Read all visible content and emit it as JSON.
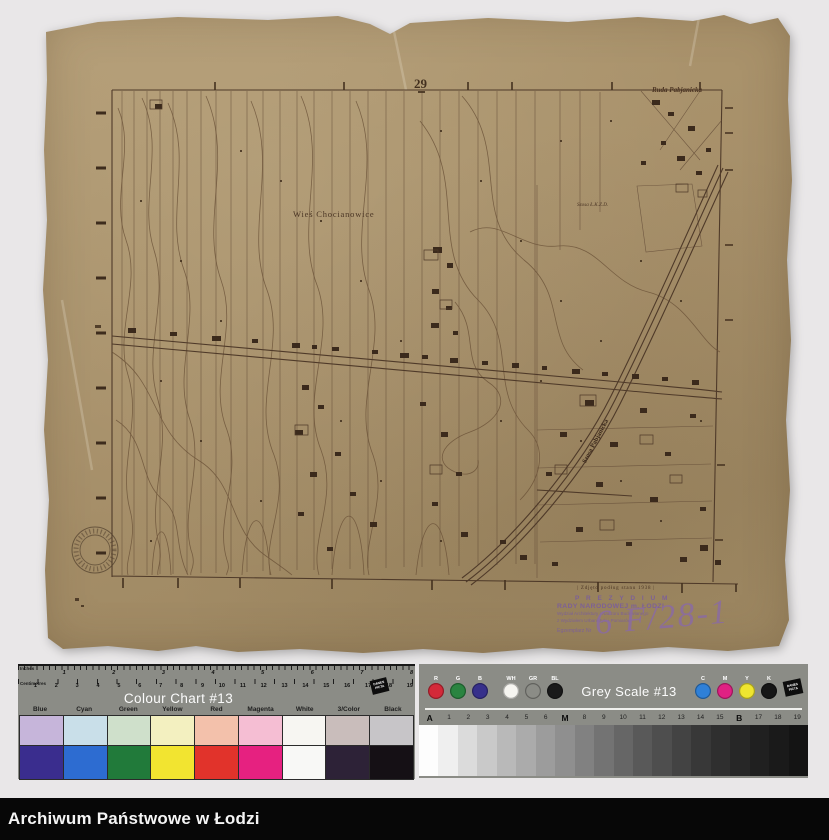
{
  "palette": {
    "background": "#e9e7e8",
    "paper": "#a8916b",
    "map_ink": "#4f3a29",
    "stamp_purple": "#7c5f99",
    "chart_grey": "#8b8c86",
    "footer_black": "#070707"
  },
  "map": {
    "sheet_number": "29",
    "corner_label": "Ruda Pabjanicka",
    "village_label": "Wieś Chocianowice",
    "road_label_small": "Szosa Ł.K.Z.D.",
    "road_label_diagonal": "Szosa Pabjanicka",
    "survey_note": "| Zdjęto podług stanu 1938 |",
    "stamp": {
      "line1": "P R E Z Y D I U M",
      "line2": "RADY NARODOWEJ m. ŁODZI",
      "line3": "Wydział Architektury i Nadzoru Budowlanego",
      "line4": "z Wydziałem Urbanistyki i Pomiarów",
      "line5": "Egzemplarz Nr",
      "handwritten": "6 F/28-1"
    }
  },
  "colour_chart": {
    "title": "Colour Chart #13",
    "ruler_top_label": "Inches",
    "ruler_bottom_label": "Centimetres",
    "logo_text": "DANES PICTA",
    "inch_numbers": [
      "1",
      "2",
      "3",
      "4",
      "5",
      "6",
      "7",
      "8"
    ],
    "cm_numbers": [
      "1",
      "2",
      "3",
      "4",
      "5",
      "6",
      "7",
      "8",
      "9",
      "10",
      "11",
      "12",
      "13",
      "14",
      "15",
      "16",
      "17",
      "18",
      "19"
    ],
    "columns": [
      {
        "label": "Blue",
        "light": "#c6b5da",
        "dark": "#3a2d8e"
      },
      {
        "label": "Cyan",
        "light": "#c9dfe9",
        "dark": "#2d6cd1"
      },
      {
        "label": "Green",
        "light": "#cfe0cb",
        "dark": "#217a3a"
      },
      {
        "label": "Yellow",
        "light": "#f3f0c0",
        "dark": "#f2e430"
      },
      {
        "label": "Red",
        "light": "#f3c1ab",
        "dark": "#e1332b"
      },
      {
        "label": "Magenta",
        "light": "#f5bed3",
        "dark": "#e62180"
      },
      {
        "label": "White",
        "light": "#f7f6f2",
        "dark": "#f8f8f6"
      },
      {
        "label": "3/Color",
        "light": "#c9bdbb",
        "dark": "#2d2237"
      },
      {
        "label": "Black",
        "light": "#c7c5c8",
        "dark": "#151015"
      }
    ]
  },
  "grey_scale": {
    "title": "Grey Scale #13",
    "logo_text": "DANES PICTA",
    "dots": [
      {
        "label": "R",
        "color": "#d32939"
      },
      {
        "label": "G",
        "color": "#2a8440"
      },
      {
        "label": "B",
        "color": "#37308b"
      },
      {
        "label": "WH",
        "color": "#f6f5f0"
      },
      {
        "label": "GR",
        "color": "#8b8c86"
      },
      {
        "label": "BL",
        "color": "#1a1a1a"
      },
      {
        "label": "C",
        "color": "#2f80d8"
      },
      {
        "label": "M",
        "color": "#e02183"
      },
      {
        "label": "Y",
        "color": "#efe52f"
      },
      {
        "label": "K",
        "color": "#161616"
      }
    ],
    "scale_labels": [
      "A",
      "1",
      "2",
      "3",
      "4",
      "5",
      "6",
      "M",
      "8",
      "9",
      "10",
      "11",
      "12",
      "13",
      "14",
      "15",
      "B",
      "17",
      "18",
      "19"
    ],
    "steps": [
      "#fdfdfd",
      "#efefef",
      "#dbdbdb",
      "#c9c9c9",
      "#b9b9b9",
      "#ababab",
      "#9c9c9c",
      "#8f8f8f",
      "#818181",
      "#737373",
      "#666666",
      "#595959",
      "#4e4e4e",
      "#434343",
      "#383838",
      "#2f2f2f",
      "#272727",
      "#202020",
      "#1a1a1a",
      "#141414"
    ]
  },
  "footer": {
    "text": "Archiwum Państwowe w Łodzi"
  }
}
